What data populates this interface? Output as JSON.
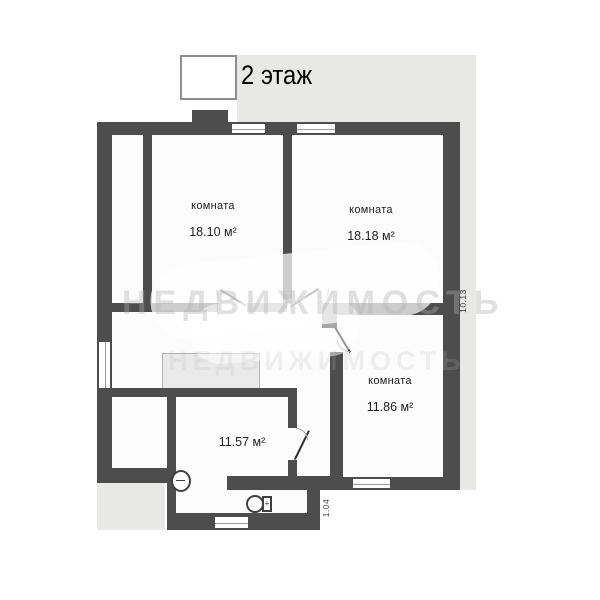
{
  "title": "2 этаж",
  "rooms": [
    {
      "name": "комната",
      "area": "18.10 м²"
    },
    {
      "name": "комната",
      "area": "18.18 м²"
    },
    {
      "name": "комната",
      "area": "11.86 м²"
    },
    {
      "name": "",
      "area": "11.57 м²"
    }
  ],
  "dimensions": {
    "right": "10.13",
    "bottom": "1.04"
  },
  "watermark": {
    "text": "НЕДВИЖИМОСТЬ"
  },
  "fixtures": {
    "toilet_tank_mark": "+"
  },
  "colors": {
    "wall": "#4d4d4d",
    "floor": "#fcfcfc",
    "panel": "#e8e8e7",
    "closet": "#eaeaea",
    "page": "#ffffff",
    "text": "#222222",
    "line": "#9c9c9c"
  }
}
